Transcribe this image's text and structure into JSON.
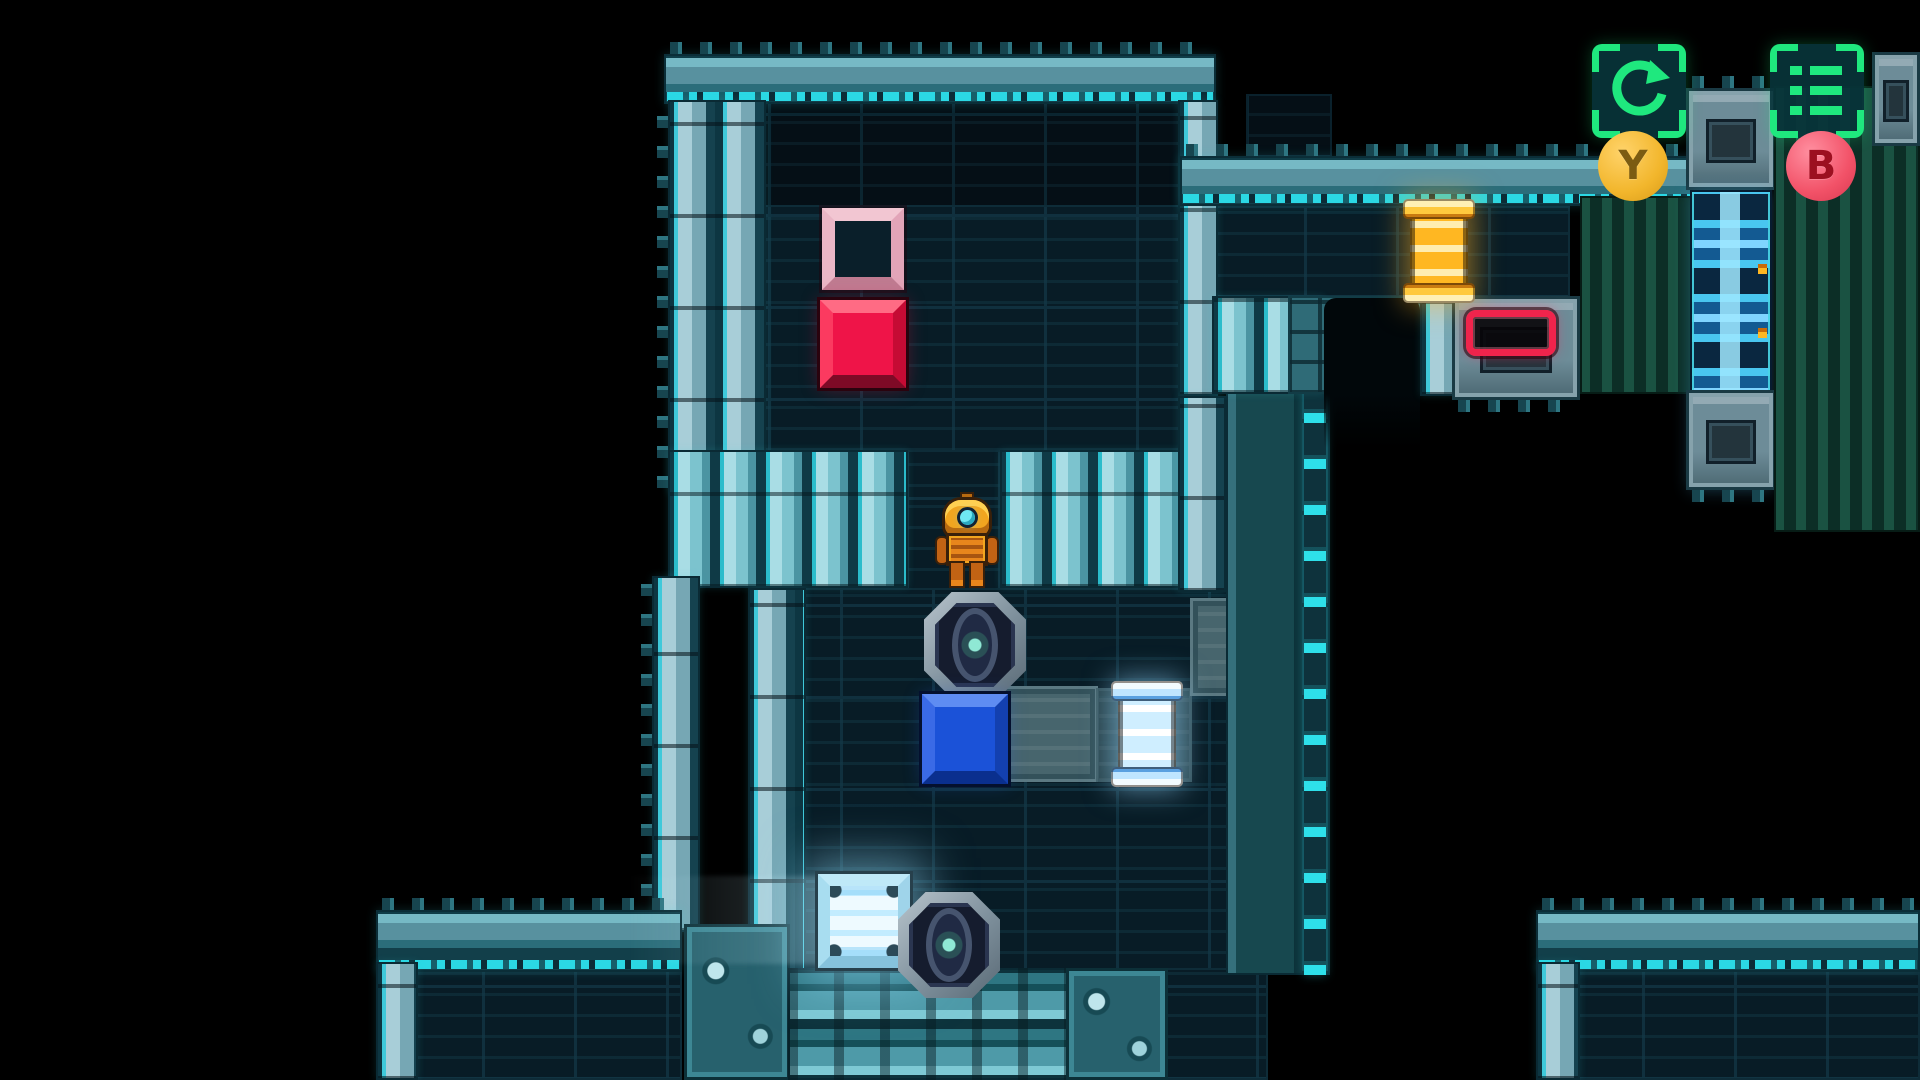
{
  "meta": {
    "width": 1920,
    "height": 1080,
    "background": "#000000",
    "description": "sci-fi robot sokoban puzzle level"
  },
  "palette": {
    "wall_teal": "#4f96a6",
    "wall_cyan_glow": "#35d9e6",
    "floor_dark": "#081c26",
    "accent_green": "#1fe87e",
    "block_red": "#ef1448",
    "block_blue": "#1b52d8",
    "target_pink": "#e2a4b8",
    "spool_orange": "#ffb722",
    "spool_blue": "#cfeeff",
    "button_y": "#f2b62c",
    "button_b": "#f25268"
  },
  "hud": {
    "restart": {
      "icon": "restart-arrow-icon",
      "button_label": "Y"
    },
    "menu": {
      "icon": "menu-list-icon",
      "button_label": "B"
    }
  },
  "tiles": [
    {
      "c": "floorDim",
      "x": 676,
      "y": 100,
      "w": 520,
      "h": 108,
      "name": "room-a-top-wall-row"
    },
    {
      "c": "floor",
      "x": 676,
      "y": 205,
      "w": 520,
      "h": 288,
      "name": "room-a-floor"
    },
    {
      "c": "floor",
      "x": 906,
      "y": 450,
      "w": 96,
      "h": 142,
      "name": "corridor-neck-floor"
    },
    {
      "c": "floor",
      "x": 748,
      "y": 588,
      "w": 550,
      "h": 387,
      "name": "corridor-floor"
    },
    {
      "c": "floor",
      "x": 1212,
      "y": 206,
      "w": 358,
      "h": 92,
      "name": "room-b-floor"
    },
    {
      "c": "floor",
      "x": 390,
      "y": 968,
      "w": 292,
      "h": 112,
      "name": "room-c-floor"
    },
    {
      "c": "floor",
      "x": 1164,
      "y": 968,
      "w": 104,
      "h": 112,
      "name": "floor-patch"
    },
    {
      "c": "floor",
      "x": 1550,
      "y": 968,
      "w": 370,
      "h": 112,
      "name": "room-d-floor"
    },
    {
      "c": "floorDim",
      "x": 1246,
      "y": 94,
      "w": 86,
      "h": 64,
      "name": "wall-fragment"
    },
    {
      "c": "floorLight",
      "x": 1002,
      "y": 686,
      "w": 96,
      "h": 96,
      "name": "path-tile"
    },
    {
      "c": "floorLightDim",
      "x": 1096,
      "y": 688,
      "w": 96,
      "h": 94,
      "name": "path-tile-dim"
    },
    {
      "c": "floorLight",
      "x": 1190,
      "y": 598,
      "w": 106,
      "h": 98,
      "name": "path-tile"
    },
    {
      "c": "cap",
      "x": 664,
      "y": 54,
      "w": 552,
      "h": 50,
      "teeth": "top",
      "name": "room-a-top-wall"
    },
    {
      "c": "stripV",
      "x": 668,
      "y": 100,
      "w": 98,
      "h": 394,
      "teeth": "left",
      "name": "room-a-left-wall"
    },
    {
      "c": "stripV",
      "x": 1178,
      "y": 100,
      "w": 40,
      "h": 296,
      "name": "room-a-right-wall"
    },
    {
      "c": "deco2",
      "x": 668,
      "y": 450,
      "w": 240,
      "h": 138,
      "name": "room-a-bottom-wall-left"
    },
    {
      "c": "deco2",
      "x": 1000,
      "y": 450,
      "w": 226,
      "h": 138,
      "name": "room-a-bottom-wall-right"
    },
    {
      "c": "stripV",
      "x": 652,
      "y": 576,
      "w": 48,
      "h": 356,
      "teeth": "left",
      "name": "corridor-outer-left-wall"
    },
    {
      "c": "stripV",
      "x": 748,
      "y": 588,
      "w": 58,
      "h": 387,
      "name": "corridor-left-wall"
    },
    {
      "c": "stripV",
      "x": 1178,
      "y": 396,
      "w": 48,
      "h": 196,
      "name": "corridor-right-wall-upper"
    },
    {
      "c": "wallR",
      "x": 1226,
      "y": 392,
      "w": 104,
      "h": 583,
      "name": "corridor-right-wall"
    },
    {
      "c": "cap",
      "x": 1180,
      "y": 156,
      "w": 516,
      "h": 50,
      "teeth": "top",
      "name": "room-b-top-wall"
    },
    {
      "c": "deco2",
      "x": 1212,
      "y": 296,
      "w": 112,
      "h": 98,
      "name": "room-b-bottom-wall"
    },
    {
      "c": "grate",
      "x": 1288,
      "y": 296,
      "w": 134,
      "h": 98,
      "name": "grate-block"
    },
    {
      "c": "arch",
      "x": 1324,
      "y": 298,
      "w": 96,
      "h": 150,
      "name": "doorway-opening"
    },
    {
      "c": "stripV",
      "x": 1420,
      "y": 296,
      "w": 34,
      "h": 100,
      "name": "doorway-right-jamb"
    },
    {
      "c": "machine",
      "x": 1452,
      "y": 296,
      "w": 128,
      "h": 104,
      "teeth": "bottom",
      "name": "pedestal"
    },
    {
      "c": "pillar",
      "x": 1580,
      "y": 196,
      "w": 116,
      "h": 198,
      "name": "pillar-wall"
    },
    {
      "c": "machine",
      "x": 1686,
      "y": 88,
      "w": 90,
      "h": 102,
      "teeth": "top",
      "name": "pipe-machine-top"
    },
    {
      "c": "pipe",
      "x": 1690,
      "y": 190,
      "w": 82,
      "h": 300,
      "name": "energy-pipe-column"
    },
    {
      "c": "machine",
      "x": 1686,
      "y": 390,
      "w": 90,
      "h": 100,
      "teeth": "bottom",
      "name": "pipe-machine-bottom"
    },
    {
      "c": "pillar",
      "x": 1774,
      "y": 86,
      "w": 146,
      "h": 446,
      "name": "pillar-wall-right"
    },
    {
      "c": "machine",
      "x": 1872,
      "y": 52,
      "w": 48,
      "h": 94,
      "name": "machine-corner"
    },
    {
      "c": "cap",
      "x": 376,
      "y": 910,
      "w": 306,
      "h": 62,
      "teeth": "top",
      "name": "room-c-top-wall"
    },
    {
      "c": "stripV",
      "x": 376,
      "y": 962,
      "w": 42,
      "h": 118,
      "name": "room-c-left-wall"
    },
    {
      "c": "deco",
      "x": 684,
      "y": 924,
      "w": 106,
      "h": 156,
      "name": "corner-bolt-block"
    },
    {
      "c": "face",
      "x": 788,
      "y": 968,
      "w": 302,
      "h": 112,
      "name": "bottom-wall-face"
    },
    {
      "c": "deco",
      "x": 1066,
      "y": 968,
      "w": 102,
      "h": 112,
      "name": "corner-bolt-block"
    },
    {
      "c": "cap",
      "x": 1536,
      "y": 910,
      "w": 384,
      "h": 62,
      "teeth": "top",
      "name": "room-d-top-wall"
    },
    {
      "c": "stripV",
      "x": 1536,
      "y": 962,
      "w": 44,
      "h": 118,
      "name": "room-d-left-wall"
    }
  ],
  "sprites": [
    {
      "t": "glowStreak",
      "name": "light-spill",
      "x": 628,
      "y": 876,
      "w": 200,
      "h": 88
    },
    {
      "t": "target",
      "name": "pink-target-socket",
      "x": 822,
      "y": 208,
      "w": 82,
      "h": 82
    },
    {
      "t": "blockRed",
      "name": "red-push-block",
      "x": 820,
      "y": 300,
      "w": 86,
      "h": 88
    },
    {
      "t": "portal",
      "name": "hatch-eye-tile",
      "x": 924,
      "y": 592,
      "w": 102,
      "h": 106
    },
    {
      "t": "blockBlue",
      "name": "blue-push-block",
      "x": 922,
      "y": 694,
      "w": 86,
      "h": 90
    },
    {
      "t": "spool spoolBlue",
      "name": "blue-energy-spool",
      "x": 1118,
      "y": 684,
      "w": 58,
      "h": 100
    },
    {
      "t": "spool spoolOrange",
      "name": "orange-energy-spool",
      "x": 1410,
      "y": 202,
      "w": 58,
      "h": 98
    },
    {
      "t": "socketRed",
      "name": "red-spool-socket",
      "x": 1466,
      "y": 310,
      "w": 90,
      "h": 46
    },
    {
      "t": "blockGlow",
      "name": "charged-glow-block",
      "x": 818,
      "y": 874,
      "w": 92,
      "h": 94
    },
    {
      "t": "portal",
      "name": "hatch-eye-tile",
      "x": 898,
      "y": 892,
      "w": 102,
      "h": 106
    },
    {
      "t": "robot",
      "name": "player-robot",
      "x": 936,
      "y": 494,
      "w": 62,
      "h": 94,
      "parts": [
        "r-antenna",
        "r-head",
        "r-eye",
        "r-arm-l",
        "r-arm-r",
        "r-torso",
        "r-leg-l",
        "r-leg-r"
      ]
    }
  ]
}
